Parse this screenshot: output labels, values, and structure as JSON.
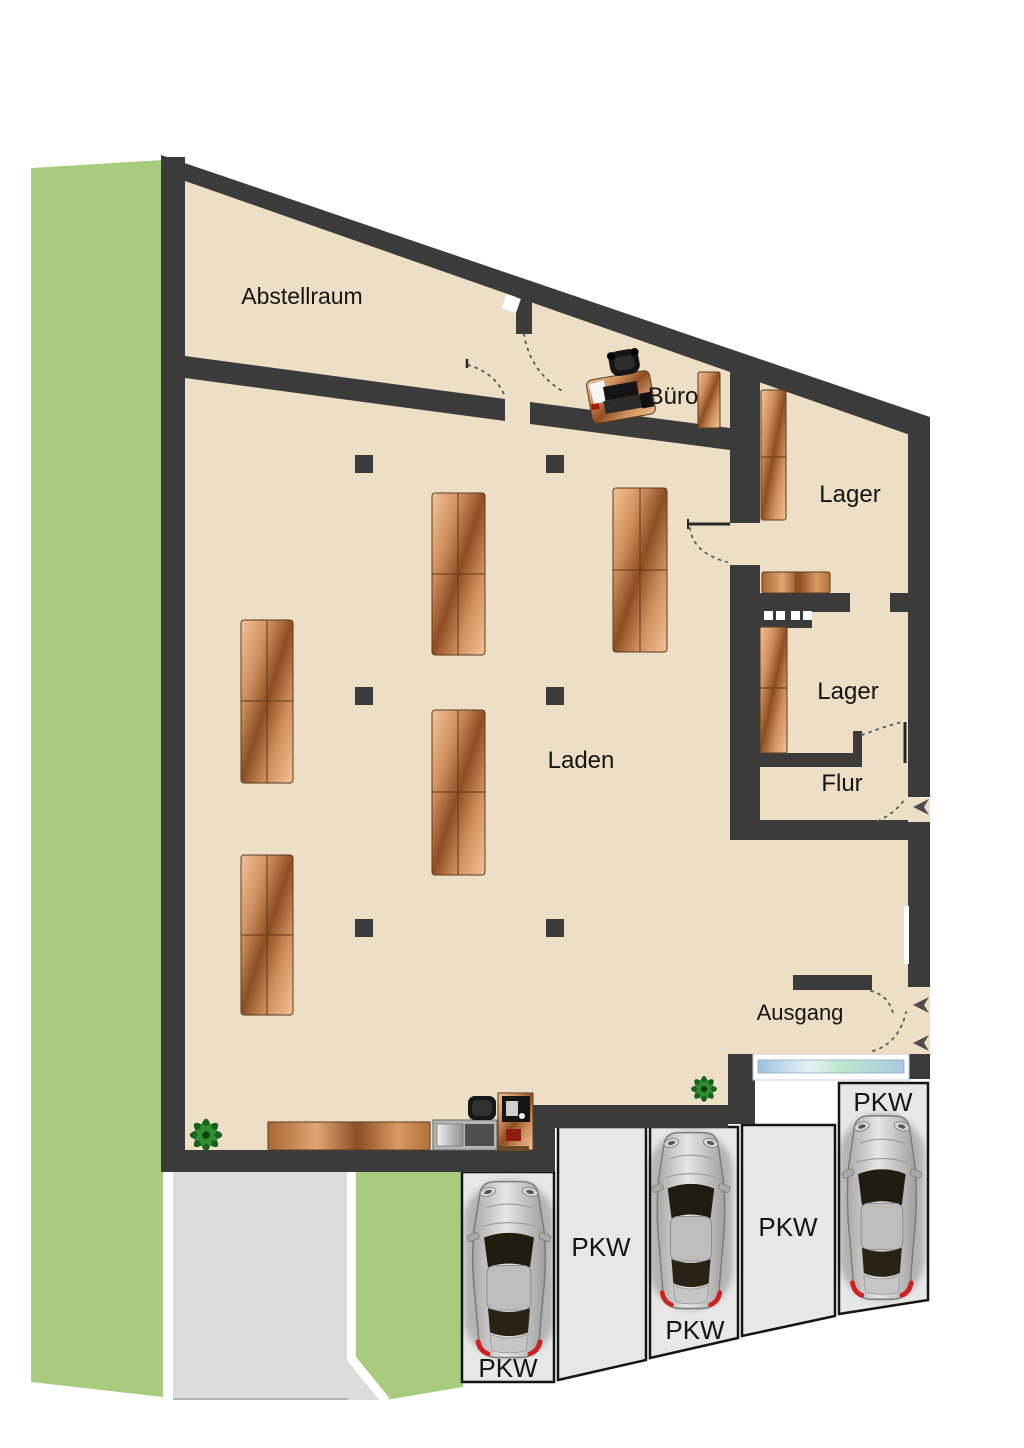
{
  "rooms": {
    "abstellraum": {
      "label": "Abstellraum"
    },
    "buero": {
      "label": "Büro"
    },
    "lager_top": {
      "label": "Lager"
    },
    "lager_mid": {
      "label": "Lager"
    },
    "flur": {
      "label": "Flur"
    },
    "laden": {
      "label": "Laden"
    },
    "ausgang": {
      "label": "Ausgang"
    }
  },
  "parking": {
    "spot1": {
      "label": "PKW",
      "occupied": true
    },
    "spot2": {
      "label": "PKW",
      "occupied": false
    },
    "spot3": {
      "label": "PKW",
      "occupied": true
    },
    "spot4": {
      "label": "PKW",
      "occupied": false
    },
    "spot5": {
      "label": "PKW",
      "occupied": true
    }
  },
  "colors": {
    "wall": "#3b3b3b",
    "floor": "#ecdfc6",
    "grass": "#a9cb7e",
    "parking_area": "#e7e7e7",
    "driveway": "#dcdcdc",
    "wood_light": "#f2c399",
    "wood_dark": "#8d4e24",
    "window_glass": "#bcd4e6",
    "taillight_red": "#cc2222"
  }
}
